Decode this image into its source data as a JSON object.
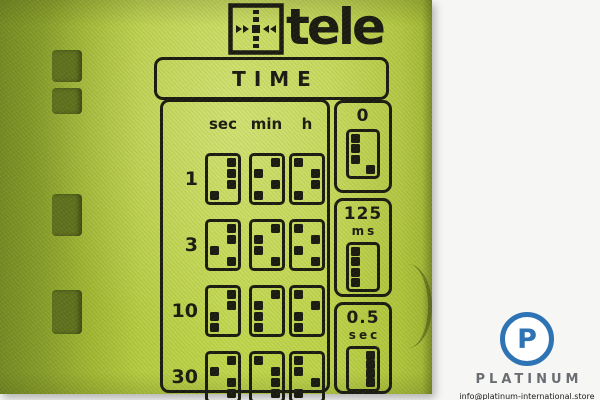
{
  "device": {
    "brand": "tele",
    "panel_title": "TIME",
    "time_table": {
      "columns": [
        "sec",
        "min",
        "h"
      ],
      "rows": [
        {
          "multiplier": "1",
          "switch_patterns": [
            [
              "R",
              "R",
              "R",
              "L"
            ],
            [
              "R",
              "L",
              "R",
              "L"
            ],
            [
              "L",
              "R",
              "R",
              "L"
            ]
          ]
        },
        {
          "multiplier": "3",
          "switch_patterns": [
            [
              "R",
              "R",
              "L",
              "R"
            ],
            [
              "R",
              "L",
              "L",
              "R"
            ],
            [
              "L",
              "R",
              "L",
              "R"
            ]
          ]
        },
        {
          "multiplier": "10",
          "switch_patterns": [
            [
              "R",
              "R",
              "L",
              "L"
            ],
            [
              "R",
              "L",
              "L",
              "L"
            ],
            [
              "L",
              "R",
              "L",
              "L"
            ]
          ]
        },
        {
          "multiplier": "30",
          "switch_patterns": [
            [
              "R",
              "L",
              "R",
              "R"
            ],
            [
              "L",
              "R",
              "R",
              "R"
            ],
            [
              "L",
              "L",
              "R",
              "L"
            ]
          ]
        }
      ]
    },
    "base_time_options": [
      {
        "value": "0",
        "unit": "",
        "switch_pattern": [
          "L",
          "L",
          "L",
          "R"
        ]
      },
      {
        "value": "125",
        "unit": "ms",
        "switch_pattern": [
          "L",
          "L",
          "L",
          "L"
        ]
      },
      {
        "value": "0.5",
        "unit": "sec",
        "switch_pattern": [
          "R",
          "R",
          "R",
          "R"
        ]
      }
    ],
    "colors": {
      "panel_green": "#bed34a",
      "print_black": "#1c1d12"
    }
  },
  "watermark": {
    "logo_letter": "P",
    "name": "PLATINUM",
    "email": "info@platinum-international.store",
    "accent_blue": "#2e73b4"
  }
}
